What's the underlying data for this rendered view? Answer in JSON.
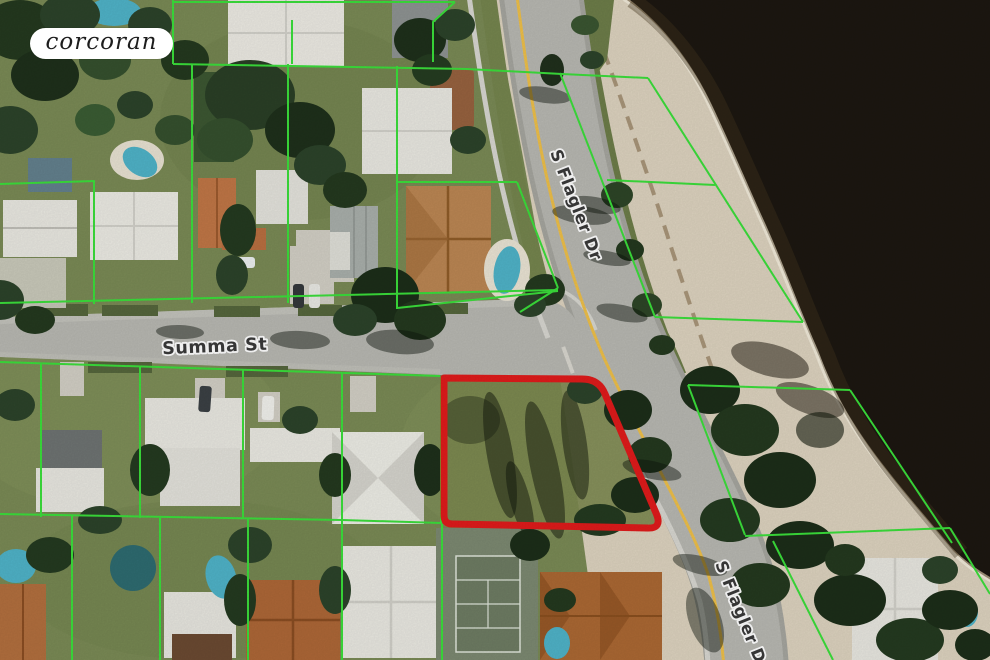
{
  "branding": {
    "logo_text": "corcoran"
  },
  "map": {
    "street_labels": [
      {
        "id": "summa",
        "text": "Summa St"
      },
      {
        "id": "flagler-north",
        "text": "S Flagler Dr"
      },
      {
        "id": "flagler-south",
        "text": "S Flagler Dr"
      }
    ],
    "colors": {
      "lawn": "#7a8a55",
      "sand": "#ddd3bf",
      "water": "#1c1711",
      "road": "#b8b8b2",
      "center_line": "#eec04a",
      "parcel_line": "#3bdf3b",
      "subject_outline": "#e01b1b",
      "pool": "#4fb3c8",
      "street_label": "#3a3a3a"
    }
  }
}
